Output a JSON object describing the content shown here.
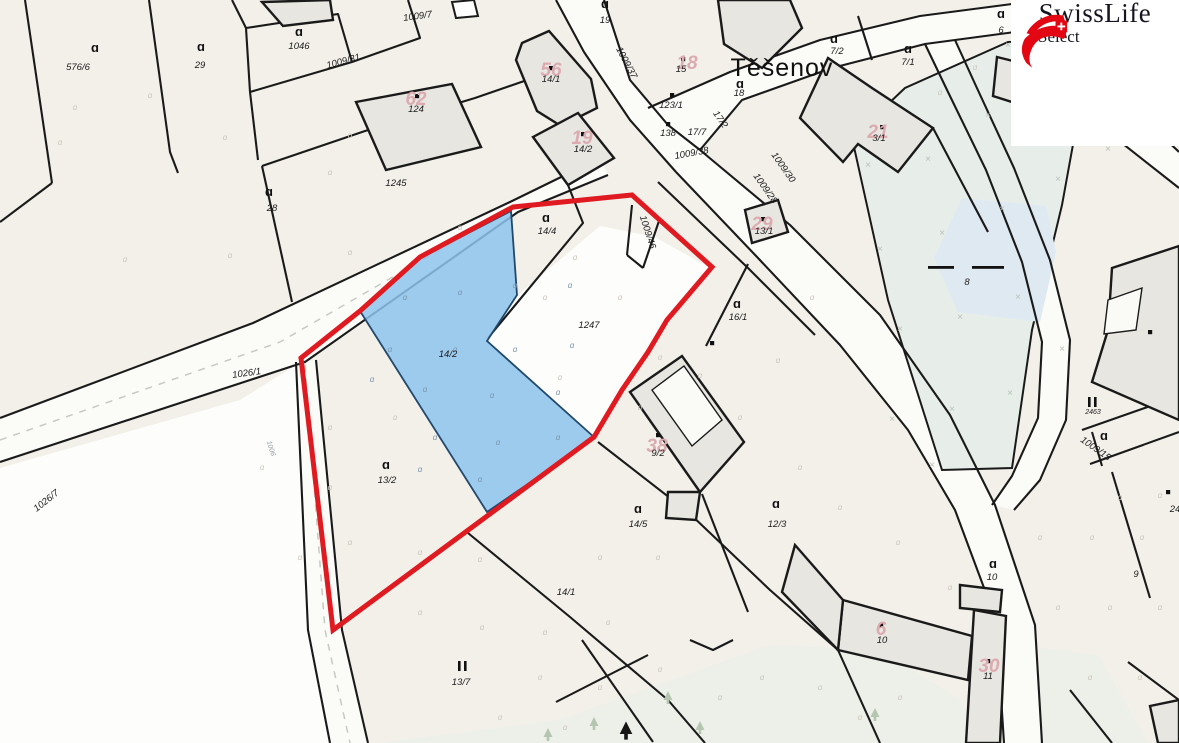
{
  "branding": {
    "title": "SwissLife",
    "subtitle": "Select"
  },
  "map": {
    "town_label": "Těšenov",
    "highlighted_parcel": "14/2",
    "colors": {
      "background": "#f2f0e9",
      "white_parcel": "#fdfdfb",
      "road": "#fbfbf8",
      "water_area": "#e7eee9",
      "water_patch": "#dfe9f2",
      "green_area": "#eaf0e8",
      "building": "#e8e6e1",
      "boundary": "#1a1a1a",
      "highlight_outline": "#df1a20",
      "highlight_fill": "#8ec4ee",
      "house_number": "#dcabb0",
      "label": "#1b1b1b",
      "symbol_faint": "#cdc6bb",
      "symbol_blue": "#7d96ad",
      "x_mark": "#b7c0b8",
      "logo_red": "#e30613"
    },
    "parcel_labels": [
      {
        "t": "576/6",
        "x": 78,
        "y": 70
      },
      {
        "t": "29",
        "x": 200,
        "y": 68
      },
      {
        "t": "1046",
        "x": 299,
        "y": 49
      },
      {
        "t": "1009/31",
        "x": 344,
        "y": 64,
        "r": -15
      },
      {
        "t": "1009/7",
        "x": 418,
        "y": 19,
        "r": -8
      },
      {
        "t": "124",
        "x": 416,
        "y": 112
      },
      {
        "t": "28",
        "x": 272,
        "y": 211
      },
      {
        "t": "1245",
        "x": 396,
        "y": 186
      },
      {
        "t": "14/1",
        "x": 551,
        "y": 82
      },
      {
        "t": "14/2",
        "x": 583,
        "y": 152
      },
      {
        "t": "19",
        "x": 605,
        "y": 23
      },
      {
        "t": "1009/37",
        "x": 624,
        "y": 64,
        "r": 62
      },
      {
        "t": "15",
        "x": 681,
        "y": 72
      },
      {
        "t": "123/1",
        "x": 671,
        "y": 108
      },
      {
        "t": "138",
        "x": 668,
        "y": 136
      },
      {
        "t": "17/7",
        "x": 697,
        "y": 135
      },
      {
        "t": "17/2",
        "x": 718,
        "y": 121,
        "r": 55
      },
      {
        "t": "1009/38",
        "x": 692,
        "y": 156,
        "r": -10
      },
      {
        "t": "18",
        "x": 739,
        "y": 96
      },
      {
        "t": "6",
        "x": 1001,
        "y": 33
      },
      {
        "t": "7/2",
        "x": 837,
        "y": 54
      },
      {
        "t": "7/1",
        "x": 908,
        "y": 65
      },
      {
        "t": "3/1",
        "x": 879,
        "y": 141
      },
      {
        "t": "1009/30",
        "x": 781,
        "y": 169,
        "r": 55
      },
      {
        "t": "1009/28",
        "x": 763,
        "y": 190,
        "r": 55
      },
      {
        "t": "13/1",
        "x": 764,
        "y": 234
      },
      {
        "t": "1009/46",
        "x": 645,
        "y": 233,
        "r": 72
      },
      {
        "t": "14/4",
        "x": 547,
        "y": 234
      },
      {
        "t": "1247",
        "x": 589,
        "y": 328
      },
      {
        "t": "16/1",
        "x": 738,
        "y": 320
      },
      {
        "t": "8",
        "x": 967,
        "y": 285
      },
      {
        "t": "9/2",
        "x": 658,
        "y": 456
      },
      {
        "t": "14/2",
        "x": 448,
        "y": 357
      },
      {
        "t": "13/2",
        "x": 387,
        "y": 483
      },
      {
        "t": "14/5",
        "x": 638,
        "y": 527
      },
      {
        "t": "12/3",
        "x": 777,
        "y": 527
      },
      {
        "t": "14/1",
        "x": 566,
        "y": 595
      },
      {
        "t": "13/7",
        "x": 461,
        "y": 685
      },
      {
        "t": "10",
        "x": 992,
        "y": 580
      },
      {
        "t": "10",
        "x": 882,
        "y": 643
      },
      {
        "t": "11",
        "x": 988,
        "y": 679
      },
      {
        "t": "9",
        "x": 1136,
        "y": 577
      },
      {
        "t": "1009/15",
        "x": 1094,
        "y": 451,
        "r": 35
      },
      {
        "t": "2463",
        "x": 1093,
        "y": 414,
        "s": 7
      },
      {
        "t": "24",
        "x": 1175,
        "y": 512
      },
      {
        "t": "1026/1",
        "x": 247,
        "y": 376,
        "r": -8
      },
      {
        "t": "1026/7",
        "x": 48,
        "y": 503,
        "r": -38
      },
      {
        "t": "1006",
        "x": 269,
        "y": 449,
        "r": 72,
        "s": 7,
        "c": "#9aa0a6"
      }
    ],
    "house_numbers": [
      {
        "t": "62",
        "x": 416,
        "y": 105
      },
      {
        "t": "56",
        "x": 551,
        "y": 76
      },
      {
        "t": "19",
        "x": 582,
        "y": 144
      },
      {
        "t": "18",
        "x": 687,
        "y": 69
      },
      {
        "t": "21",
        "x": 878,
        "y": 138
      },
      {
        "t": "29",
        "x": 762,
        "y": 230
      },
      {
        "t": "38",
        "x": 657,
        "y": 452
      },
      {
        "t": "6",
        "x": 881,
        "y": 635
      },
      {
        "t": "30",
        "x": 989,
        "y": 672
      }
    ],
    "symbols": {
      "landuse_a_bold": [
        [
          95,
          52
        ],
        [
          201,
          51
        ],
        [
          299,
          36
        ],
        [
          269,
          196
        ],
        [
          546,
          222
        ],
        [
          605,
          8
        ],
        [
          740,
          88
        ],
        [
          834,
          43
        ],
        [
          908,
          53
        ],
        [
          386,
          469
        ],
        [
          638,
          513
        ],
        [
          776,
          508
        ],
        [
          993,
          568
        ],
        [
          737,
          308
        ],
        [
          1001,
          18
        ],
        [
          1104,
          440
        ]
      ],
      "landuse_a_small": [
        [
          60,
          145
        ],
        [
          150,
          98
        ],
        [
          225,
          140
        ],
        [
          350,
          138
        ],
        [
          75,
          110
        ],
        [
          330,
          175
        ],
        [
          125,
          262
        ],
        [
          230,
          258
        ],
        [
          350,
          255
        ],
        [
          460,
          230
        ],
        [
          330,
          430
        ],
        [
          395,
          420
        ],
        [
          262,
          470
        ],
        [
          330,
          490
        ],
        [
          350,
          545
        ],
        [
          420,
          555
        ],
        [
          480,
          562
        ],
        [
          300,
          560
        ],
        [
          420,
          615
        ],
        [
          482,
          630
        ],
        [
          545,
          635
        ],
        [
          608,
          625
        ],
        [
          540,
          680
        ],
        [
          600,
          690
        ],
        [
          660,
          672
        ],
        [
          500,
          720
        ],
        [
          565,
          730
        ],
        [
          720,
          700
        ],
        [
          762,
          680
        ],
        [
          820,
          690
        ],
        [
          900,
          700
        ],
        [
          860,
          720
        ],
        [
          700,
          378
        ],
        [
          740,
          420
        ],
        [
          800,
          470
        ],
        [
          840,
          510
        ],
        [
          898,
          545
        ],
        [
          1040,
          540
        ],
        [
          1092,
          540
        ],
        [
          1142,
          540
        ],
        [
          1058,
          610
        ],
        [
          1110,
          610
        ],
        [
          1160,
          610
        ],
        [
          1090,
          680
        ],
        [
          1140,
          680
        ],
        [
          545,
          300
        ],
        [
          620,
          300
        ],
        [
          660,
          360
        ],
        [
          560,
          380
        ],
        [
          640,
          410
        ],
        [
          575,
          260
        ],
        [
          940,
          95
        ],
        [
          975,
          70
        ],
        [
          600,
          560
        ],
        [
          658,
          560
        ],
        [
          950,
          590
        ],
        [
          1120,
          500
        ],
        [
          1160,
          498
        ],
        [
          778,
          363
        ],
        [
          812,
          300
        ]
      ],
      "landuse_a_small_blue": [
        [
          405,
          300
        ],
        [
          460,
          295
        ],
        [
          515,
          288
        ],
        [
          570,
          288
        ],
        [
          390,
          352
        ],
        [
          455,
          352
        ],
        [
          515,
          352
        ],
        [
          572,
          348
        ],
        [
          372,
          382
        ],
        [
          425,
          392
        ],
        [
          492,
          398
        ],
        [
          558,
          395
        ],
        [
          435,
          440
        ],
        [
          498,
          445
        ],
        [
          558,
          440
        ],
        [
          420,
          472
        ],
        [
          480,
          482
        ]
      ],
      "meadow_bars": [
        [
          463,
          670
        ],
        [
          1093,
          406
        ]
      ],
      "x_marks": [
        [
          868,
          168
        ],
        [
          928,
          162
        ],
        [
          988,
          118
        ],
        [
          1048,
          95
        ],
        [
          880,
          252
        ],
        [
          942,
          236
        ],
        [
          1002,
          212
        ],
        [
          1058,
          182
        ],
        [
          900,
          332
        ],
        [
          960,
          320
        ],
        [
          1018,
          300
        ],
        [
          892,
          422
        ],
        [
          952,
          412
        ],
        [
          1010,
          396
        ],
        [
          1062,
          352
        ],
        [
          932,
          468
        ],
        [
          1108,
          152
        ],
        [
          1008,
          48
        ]
      ],
      "water_dashes": [
        [
          928,
          266,
          26
        ],
        [
          972,
          266,
          32
        ]
      ],
      "building_dots": [
        [
          551,
          68
        ],
        [
          417,
          96
        ],
        [
          583,
          134
        ],
        [
          683,
          59
        ],
        [
          672,
          95
        ],
        [
          668,
          124
        ],
        [
          763,
          219
        ],
        [
          882,
          127
        ],
        [
          658,
          435
        ],
        [
          881,
          625
        ],
        [
          988,
          661
        ],
        [
          1150,
          332
        ],
        [
          712,
          343
        ],
        [
          1168,
          492
        ]
      ],
      "trees_dark": [
        [
          626,
          734
        ]
      ],
      "trees_light": [
        [
          594,
          726
        ],
        [
          668,
          700
        ],
        [
          548,
          737
        ],
        [
          700,
          730
        ],
        [
          875,
          717
        ]
      ]
    }
  }
}
